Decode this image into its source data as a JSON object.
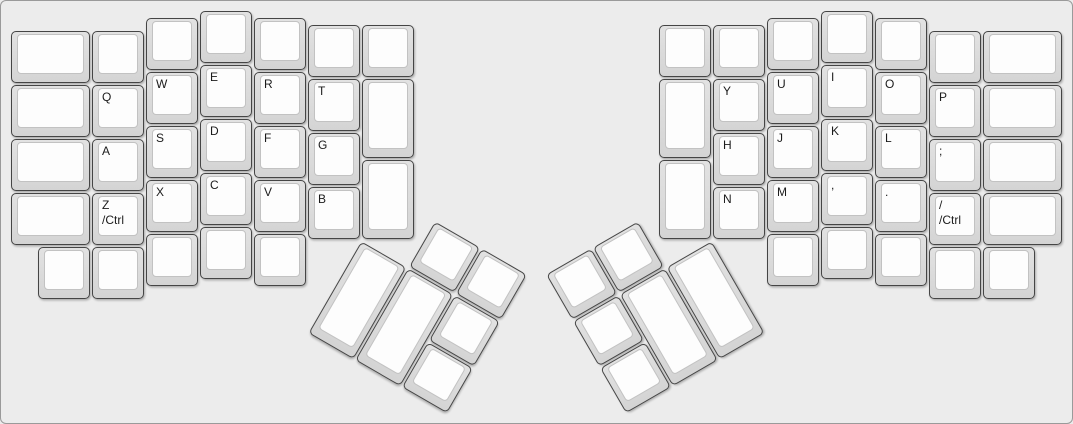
{
  "board": {
    "unit_px": 54,
    "margin_px": 10,
    "layout_name": "ergodox-split-keyboard",
    "colors": {
      "background": "#ececec",
      "frame_border": "#9a9a9a",
      "cap_base_top": "#e2e2e2",
      "cap_base_bottom": "#d4d4d4",
      "cap_border": "#454545",
      "cap_face": "#fdfdfd",
      "face_border": "#c2c2c2",
      "label": "#1b1b1b"
    }
  },
  "keys": [
    {
      "name": "key-blank",
      "x": 0,
      "y": 0.375,
      "w": 1.5,
      "labels": []
    },
    {
      "name": "key-blank",
      "x": 1.5,
      "y": 0.375,
      "labels": []
    },
    {
      "name": "key-blank",
      "x": 2.5,
      "y": 0.125,
      "labels": []
    },
    {
      "name": "key-blank",
      "x": 3.5,
      "y": 0,
      "labels": []
    },
    {
      "name": "key-blank",
      "x": 4.5,
      "y": 0.125,
      "labels": []
    },
    {
      "name": "key-blank",
      "x": 5.5,
      "y": 0.25,
      "labels": []
    },
    {
      "name": "key-blank",
      "x": 6.5,
      "y": 0.25,
      "labels": []
    },
    {
      "name": "key-blank",
      "x": 0,
      "y": 1.375,
      "w": 1.5,
      "labels": []
    },
    {
      "name": "key-q",
      "x": 1.5,
      "y": 1.375,
      "labels": [
        "Q"
      ]
    },
    {
      "name": "key-w",
      "x": 2.5,
      "y": 1.125,
      "labels": [
        "W"
      ]
    },
    {
      "name": "key-e",
      "x": 3.5,
      "y": 1,
      "labels": [
        "E"
      ]
    },
    {
      "name": "key-r",
      "x": 4.5,
      "y": 1.125,
      "labels": [
        "R"
      ]
    },
    {
      "name": "key-t",
      "x": 5.5,
      "y": 1.25,
      "labels": [
        "T"
      ]
    },
    {
      "name": "key-blank",
      "x": 6.5,
      "y": 1.25,
      "h": 1.5,
      "labels": []
    },
    {
      "name": "key-blank",
      "x": 0,
      "y": 2.375,
      "w": 1.5,
      "labels": []
    },
    {
      "name": "key-a",
      "x": 1.5,
      "y": 2.375,
      "labels": [
        "A"
      ]
    },
    {
      "name": "key-s",
      "x": 2.5,
      "y": 2.125,
      "labels": [
        "S"
      ]
    },
    {
      "name": "key-d",
      "x": 3.5,
      "y": 2,
      "labels": [
        "D"
      ]
    },
    {
      "name": "key-f",
      "x": 4.5,
      "y": 2.125,
      "labels": [
        "F"
      ]
    },
    {
      "name": "key-g",
      "x": 5.5,
      "y": 2.25,
      "labels": [
        "G"
      ]
    },
    {
      "name": "key-blank",
      "x": 0,
      "y": 3.375,
      "w": 1.5,
      "labels": []
    },
    {
      "name": "key-z-ctrl",
      "x": 1.5,
      "y": 3.375,
      "labels": [
        "Z",
        "/Ctrl"
      ]
    },
    {
      "name": "key-x",
      "x": 2.5,
      "y": 3.125,
      "labels": [
        "X"
      ]
    },
    {
      "name": "key-c",
      "x": 3.5,
      "y": 3,
      "labels": [
        "C"
      ]
    },
    {
      "name": "key-v",
      "x": 4.5,
      "y": 3.125,
      "labels": [
        "V"
      ]
    },
    {
      "name": "key-b",
      "x": 5.5,
      "y": 3.25,
      "labels": [
        "B"
      ]
    },
    {
      "name": "key-blank",
      "x": 6.5,
      "y": 2.75,
      "h": 1.5,
      "labels": []
    },
    {
      "name": "key-blank",
      "x": 0.5,
      "y": 4.375,
      "labels": []
    },
    {
      "name": "key-blank",
      "x": 1.5,
      "y": 4.375,
      "labels": []
    },
    {
      "name": "key-blank",
      "x": 2.5,
      "y": 4.125,
      "labels": []
    },
    {
      "name": "key-blank",
      "x": 3.5,
      "y": 4,
      "labels": []
    },
    {
      "name": "key-blank",
      "x": 4.5,
      "y": 4.125,
      "labels": []
    },
    {
      "name": "key-blank-thumb",
      "x": 7.5,
      "y": 3.25,
      "r": 30,
      "rx": 6.5,
      "ry": 4.25,
      "labels": []
    },
    {
      "name": "key-blank-thumb",
      "x": 8.5,
      "y": 3.25,
      "r": 30,
      "rx": 6.5,
      "ry": 4.25,
      "labels": []
    },
    {
      "name": "key-blank-thumb",
      "x": 6.5,
      "y": 4.25,
      "h": 2,
      "r": 30,
      "rx": 6.5,
      "ry": 4.25,
      "labels": []
    },
    {
      "name": "key-blank-thumb",
      "x": 7.5,
      "y": 4.25,
      "h": 2,
      "r": 30,
      "rx": 6.5,
      "ry": 4.25,
      "labels": []
    },
    {
      "name": "key-blank-thumb",
      "x": 8.5,
      "y": 4.25,
      "r": 30,
      "rx": 6.5,
      "ry": 4.25,
      "labels": []
    },
    {
      "name": "key-blank-thumb",
      "x": 8.5,
      "y": 5.25,
      "r": 30,
      "rx": 6.5,
      "ry": 4.25,
      "labels": []
    },
    {
      "name": "key-blank",
      "x": 12,
      "y": 0.25,
      "labels": []
    },
    {
      "name": "key-blank",
      "x": 13,
      "y": 0.25,
      "labels": []
    },
    {
      "name": "key-blank",
      "x": 14,
      "y": 0.125,
      "labels": []
    },
    {
      "name": "key-blank",
      "x": 15,
      "y": 0,
      "labels": []
    },
    {
      "name": "key-blank",
      "x": 16,
      "y": 0.125,
      "labels": []
    },
    {
      "name": "key-blank",
      "x": 17,
      "y": 0.375,
      "labels": []
    },
    {
      "name": "key-blank",
      "x": 18,
      "y": 0.375,
      "w": 1.5,
      "labels": []
    },
    {
      "name": "key-blank",
      "x": 12,
      "y": 1.25,
      "h": 1.5,
      "labels": []
    },
    {
      "name": "key-y",
      "x": 13,
      "y": 1.25,
      "labels": [
        "Y"
      ]
    },
    {
      "name": "key-u",
      "x": 14,
      "y": 1.125,
      "labels": [
        "U"
      ]
    },
    {
      "name": "key-i",
      "x": 15,
      "y": 1,
      "labels": [
        "I"
      ]
    },
    {
      "name": "key-o",
      "x": 16,
      "y": 1.125,
      "labels": [
        "O"
      ]
    },
    {
      "name": "key-p",
      "x": 17,
      "y": 1.375,
      "labels": [
        "P"
      ]
    },
    {
      "name": "key-blank",
      "x": 18,
      "y": 1.375,
      "w": 1.5,
      "labels": []
    },
    {
      "name": "key-h",
      "x": 13,
      "y": 2.25,
      "labels": [
        "H"
      ]
    },
    {
      "name": "key-j",
      "x": 14,
      "y": 2.125,
      "labels": [
        "J"
      ]
    },
    {
      "name": "key-k",
      "x": 15,
      "y": 2,
      "labels": [
        "K"
      ]
    },
    {
      "name": "key-l",
      "x": 16,
      "y": 2.125,
      "labels": [
        "L"
      ]
    },
    {
      "name": "key-semicolon",
      "x": 17,
      "y": 2.375,
      "labels": [
        ";"
      ]
    },
    {
      "name": "key-blank",
      "x": 18,
      "y": 2.375,
      "w": 1.5,
      "labels": []
    },
    {
      "name": "key-blank",
      "x": 12,
      "y": 2.75,
      "h": 1.5,
      "labels": []
    },
    {
      "name": "key-n",
      "x": 13,
      "y": 3.25,
      "labels": [
        "N"
      ]
    },
    {
      "name": "key-m",
      "x": 14,
      "y": 3.125,
      "labels": [
        "M"
      ]
    },
    {
      "name": "key-comma",
      "x": 15,
      "y": 3,
      "labels": [
        ","
      ]
    },
    {
      "name": "key-period",
      "x": 16,
      "y": 3.125,
      "labels": [
        "."
      ]
    },
    {
      "name": "key-slash-ctrl",
      "x": 17,
      "y": 3.375,
      "labels": [
        "/",
        "/Ctrl"
      ]
    },
    {
      "name": "key-blank",
      "x": 18,
      "y": 3.375,
      "w": 1.5,
      "labels": []
    },
    {
      "name": "key-blank",
      "x": 14,
      "y": 4.125,
      "labels": []
    },
    {
      "name": "key-blank",
      "x": 15,
      "y": 4,
      "labels": []
    },
    {
      "name": "key-blank",
      "x": 16,
      "y": 4.125,
      "labels": []
    },
    {
      "name": "key-blank",
      "x": 17,
      "y": 4.375,
      "labels": []
    },
    {
      "name": "key-blank",
      "x": 18,
      "y": 4.375,
      "labels": []
    },
    {
      "name": "key-blank-thumb",
      "x": 10,
      "y": 3.25,
      "r": -30,
      "rx": 13,
      "ry": 4.25,
      "labels": []
    },
    {
      "name": "key-blank-thumb",
      "x": 11,
      "y": 3.25,
      "r": -30,
      "rx": 13,
      "ry": 4.25,
      "labels": []
    },
    {
      "name": "key-blank-thumb",
      "x": 10,
      "y": 4.25,
      "r": -30,
      "rx": 13,
      "ry": 4.25,
      "labels": []
    },
    {
      "name": "key-blank-thumb",
      "x": 11,
      "y": 4.25,
      "h": 2,
      "r": -30,
      "rx": 13,
      "ry": 4.25,
      "labels": []
    },
    {
      "name": "key-blank-thumb",
      "x": 12,
      "y": 4.25,
      "h": 2,
      "r": -30,
      "rx": 13,
      "ry": 4.25,
      "labels": []
    },
    {
      "name": "key-blank-thumb",
      "x": 10,
      "y": 5.25,
      "r": -30,
      "rx": 13,
      "ry": 4.25,
      "labels": []
    }
  ]
}
